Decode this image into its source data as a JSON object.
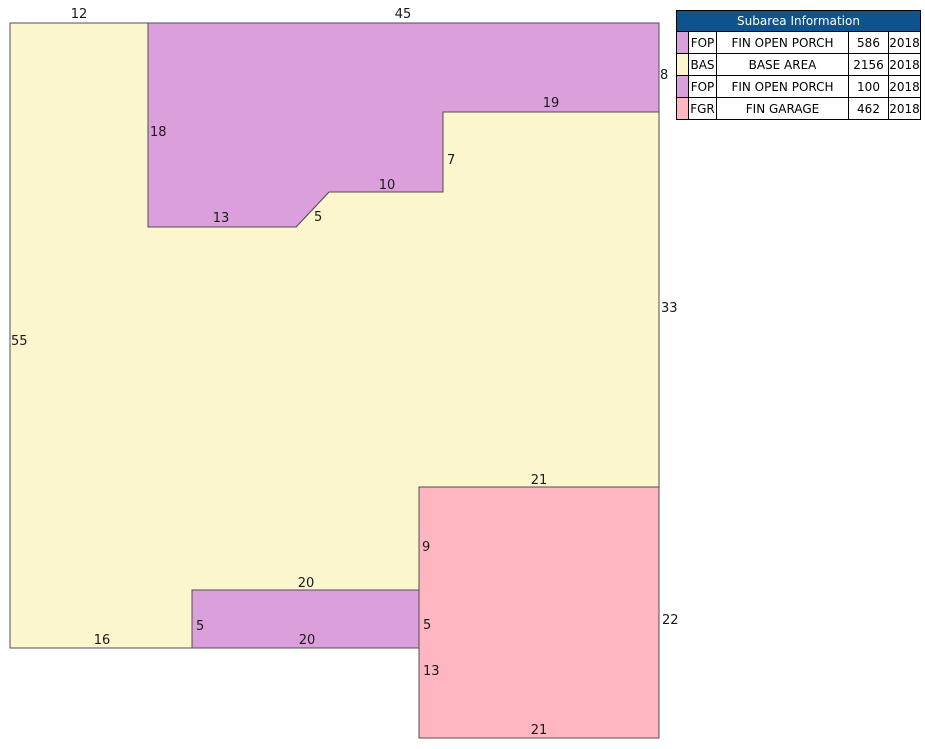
{
  "table": {
    "title": "Subarea Information",
    "header_bg": "#0e538c",
    "header_text_color": "#ffffff",
    "rows": [
      {
        "code": "FOP",
        "description": "FIN OPEN PORCH",
        "area": "586",
        "year": "2018",
        "color": "#dba0dc"
      },
      {
        "code": "BAS",
        "description": "BASE AREA",
        "area": "2156",
        "year": "2018",
        "color": "#fcf6ce"
      },
      {
        "code": "FOP",
        "description": "FIN OPEN PORCH",
        "area": "100",
        "year": "2018",
        "color": "#dba0dc"
      },
      {
        "code": "FGR",
        "description": "FIN GARAGE",
        "area": "462",
        "year": "2018",
        "color": "#ffb6c1"
      }
    ]
  },
  "sketch": {
    "outline_color": "#4f4f4f",
    "label_color": "#1a1a1a",
    "shapes": [
      {
        "name": "base-area",
        "color": "#fcf6ce",
        "points": "10,23 148,23 148,227 296,227 329,192 443,192 443,112 659,112 659,487 419,487 419,590 192,590 192,648 10,648"
      },
      {
        "name": "fin-open-porch-upper",
        "color": "#dba0dc",
        "points": "148,23 659,23 659,112 443,112 443,192 329,192 296,227 148,227"
      },
      {
        "name": "fin-garage",
        "color": "#ffb6c1",
        "points": "419,487 659,487 659,738 419,738"
      },
      {
        "name": "fin-open-porch-lower",
        "color": "#dba0dc",
        "points": "192,590 419,590 419,648 192,648"
      }
    ],
    "dimension_labels": [
      {
        "text": "12",
        "x": 79,
        "y": 18,
        "anchor": "middle"
      },
      {
        "text": "45",
        "x": 403,
        "y": 18,
        "anchor": "middle"
      },
      {
        "text": "8",
        "x": 660,
        "y": 79,
        "anchor": "start"
      },
      {
        "text": "19",
        "x": 551,
        "y": 107,
        "anchor": "middle"
      },
      {
        "text": "18",
        "x": 150,
        "y": 136,
        "anchor": "start"
      },
      {
        "text": "7",
        "x": 447,
        "y": 164,
        "anchor": "start"
      },
      {
        "text": "10",
        "x": 387,
        "y": 189,
        "anchor": "middle"
      },
      {
        "text": "5",
        "x": 314,
        "y": 221,
        "anchor": "start"
      },
      {
        "text": "13",
        "x": 221,
        "y": 222,
        "anchor": "middle"
      },
      {
        "text": "33",
        "x": 661,
        "y": 312,
        "anchor": "start"
      },
      {
        "text": "55",
        "x": 11,
        "y": 345,
        "anchor": "start"
      },
      {
        "text": "21",
        "x": 539,
        "y": 484,
        "anchor": "middle"
      },
      {
        "text": "9",
        "x": 422,
        "y": 551,
        "anchor": "start"
      },
      {
        "text": "20",
        "x": 306,
        "y": 587,
        "anchor": "middle"
      },
      {
        "text": "22",
        "x": 662,
        "y": 624,
        "anchor": "start"
      },
      {
        "text": "5",
        "x": 196,
        "y": 630,
        "anchor": "start"
      },
      {
        "text": "5",
        "x": 423,
        "y": 629,
        "anchor": "start"
      },
      {
        "text": "16",
        "x": 102,
        "y": 644,
        "anchor": "middle"
      },
      {
        "text": "20",
        "x": 307,
        "y": 644,
        "anchor": "middle"
      },
      {
        "text": "13",
        "x": 423,
        "y": 675,
        "anchor": "start"
      },
      {
        "text": "21",
        "x": 539,
        "y": 734,
        "anchor": "middle"
      }
    ]
  }
}
